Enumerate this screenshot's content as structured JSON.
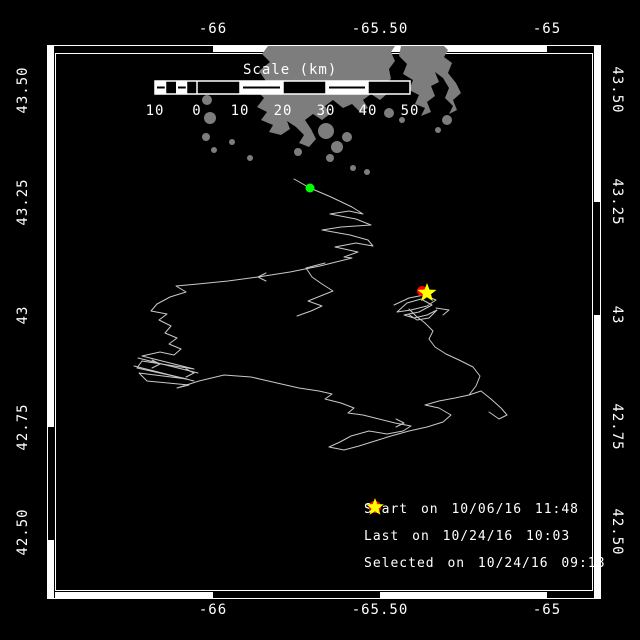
{
  "colors": {
    "background": "#000000",
    "frame": "#ffffff",
    "land": "#7d7d7d",
    "track": "#c8c8c8",
    "start_marker": "#00ff00",
    "last_marker": "#ff0000",
    "selected_marker": "#ffff00",
    "label_text": "#ffffff"
  },
  "axes": {
    "top_labels": [
      "-66",
      "-65.50",
      "-65"
    ],
    "bottom_labels": [
      "-66",
      "-65.50",
      "-65"
    ],
    "left_labels": [
      "43.50",
      "43.25",
      "43",
      "42.75",
      "42.50"
    ],
    "right_labels": [
      "43.50",
      "43.25",
      "43",
      "42.75",
      "42.50"
    ]
  },
  "scale_bar": {
    "title": "Scale (km)",
    "tick_labels": [
      "10",
      "0",
      "10",
      "20",
      "30",
      "40",
      "50"
    ]
  },
  "legend": {
    "items": [
      {
        "marker": "circle",
        "color": "#00ff00",
        "label": "Start on 10/06/16 11:48"
      },
      {
        "marker": "circle",
        "color": "#ff0000",
        "label": "Last on 10/24/16 10:03"
      },
      {
        "marker": "star",
        "color": "#ffff00",
        "label": "Selected on 10/24/16 09:18"
      }
    ]
  },
  "markers": {
    "start": {
      "x": 310,
      "y": 188
    },
    "last": {
      "x": 422,
      "y": 291
    },
    "selected": {
      "x": 427,
      "y": 293
    }
  }
}
